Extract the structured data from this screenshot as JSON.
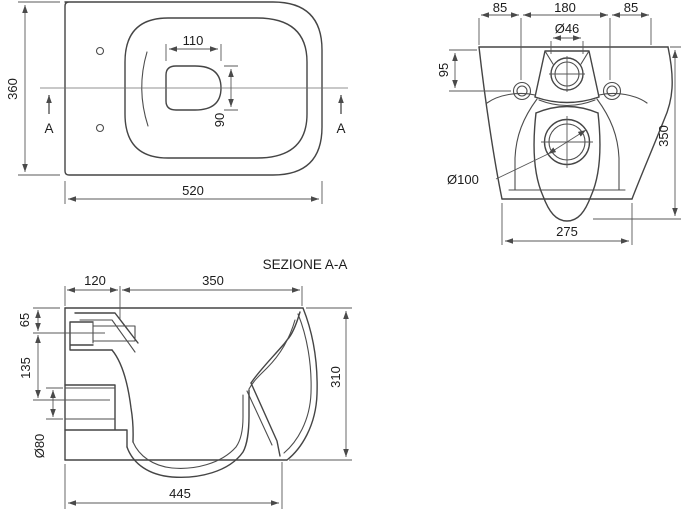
{
  "colors": {
    "background": "#ffffff",
    "object_line": "#454545",
    "dimension_line": "#585858",
    "text": "#1c1c1c"
  },
  "plan_view": {
    "dim_depth": "360",
    "dim_bowl_width": "110",
    "dim_bowl_depth": "90",
    "dim_width": "520",
    "marker_left": "A",
    "marker_right": "A"
  },
  "rear_view": {
    "dim_offset_left": "85",
    "dim_hole_spacing": "180",
    "dim_offset_right": "85",
    "dim_inlet_dia": "Ø46",
    "dim_inlet_height": "95",
    "dim_total_height": "350",
    "dim_outlet_dia": "Ø100",
    "dim_bottom_width": "275"
  },
  "section_view": {
    "title": "SEZIONE A-A",
    "dim_back_zone": "120",
    "dim_seat_zone": "350",
    "dim_top_to_inlet": "65",
    "dim_inlet_to_outlet": "135",
    "dim_outlet_dia": "Ø80",
    "dim_height": "310",
    "dim_bottom_depth": "445"
  }
}
